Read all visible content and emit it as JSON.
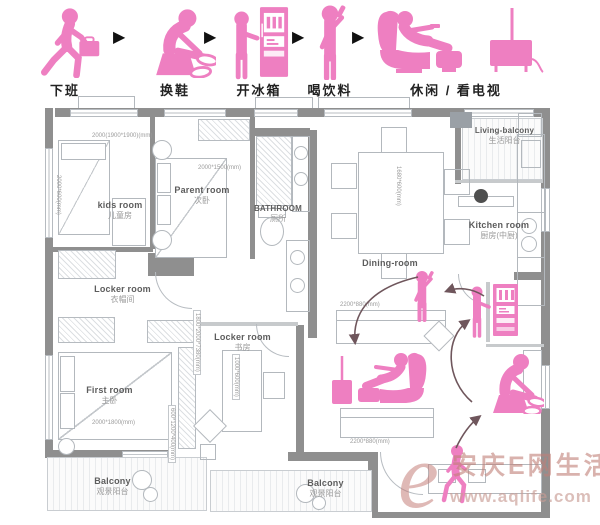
{
  "header": {
    "arrow": "▶",
    "steps": [
      {
        "label": "下班"
      },
      {
        "label": "换鞋"
      },
      {
        "label": "开冰箱"
      },
      {
        "label": "喝饮料"
      },
      {
        "label": "休闲 / 看电视"
      }
    ]
  },
  "plan": {
    "rooms": {
      "kids": {
        "en": "kids room",
        "zh": "儿童房"
      },
      "parent": {
        "en": "Parent room",
        "zh": "次卧"
      },
      "bathroom": {
        "en": "BATHROOM",
        "zh": "厕所"
      },
      "dining": {
        "en": "Dining-room"
      },
      "kitchen": {
        "en": "Kitchen room",
        "zh": "厨房(中厨)"
      },
      "living_balcony": {
        "en": "Living-balcony",
        "zh": "生活阳台"
      },
      "locker": {
        "en": "Locker room",
        "zh": "衣帽间"
      },
      "study": {
        "en": "Locker room",
        "zh": "书房"
      },
      "first": {
        "en": "First room",
        "zh": "主卧"
      },
      "balcony_left": {
        "en": "Balcony",
        "zh": "观景阳台"
      },
      "balcony_mid": {
        "en": "Balcony",
        "zh": "观景阳台"
      }
    },
    "dims": {
      "kids_top": "2000(1900*1900)(mm)",
      "kids_left": "2000*600(mm)",
      "parent": "2000*1500(mm)",
      "dining": "1680*600(mm)",
      "wardrobe": "1800*2000*7380(mm)",
      "first_side": "600*1200*400(mm)",
      "first": "2000*1800(mm)",
      "desk": "1000*600(mm)",
      "sofa_top": "2200*880(mm)",
      "sofa_bottom": "2200*880(mm)"
    }
  },
  "watermark": {
    "e": "e",
    "brand": "安庆E网生活",
    "url": "www.aqlife.com"
  },
  "colors": {
    "pink": "#ee7fc1",
    "wall": "#8f8f8f",
    "flow_arrow": "#6f565c",
    "watermark": "#c5807c"
  }
}
